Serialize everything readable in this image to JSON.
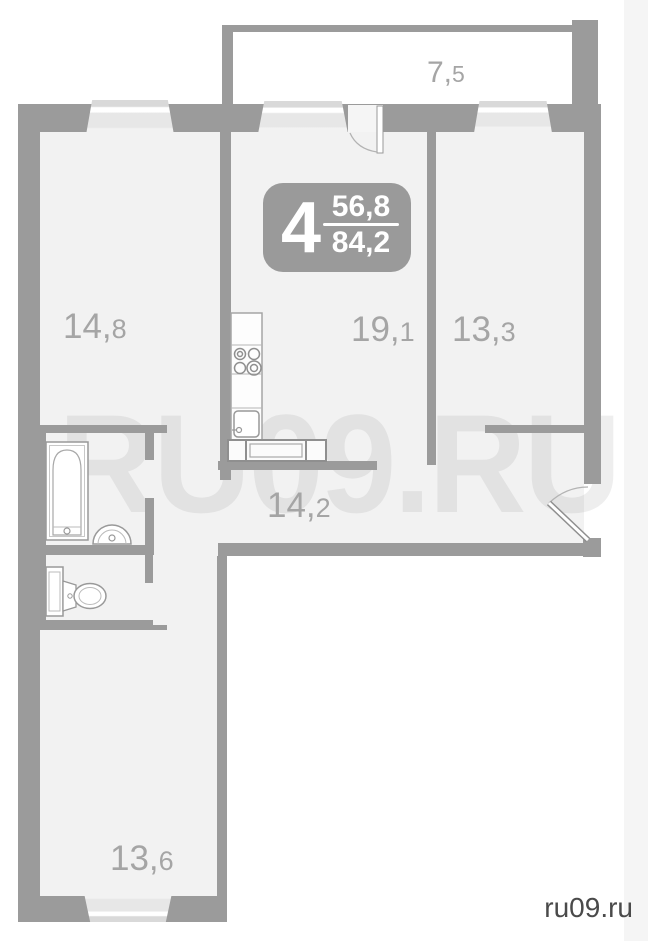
{
  "site_label": "ru09.ru",
  "watermark": "RU09.RU",
  "badge": {
    "rooms": "4",
    "area_top": "56,8",
    "area_bottom": "84,2"
  },
  "areas": {
    "balcony": {
      "main": "7,",
      "sub": "5"
    },
    "room_left": {
      "main": "14,",
      "sub": "8"
    },
    "living": {
      "main": "19,",
      "sub": "1"
    },
    "room_right": {
      "main": "13,",
      "sub": "3"
    },
    "hall": {
      "main": "14,",
      "sub": "2"
    },
    "room_bottom": {
      "main": "13,",
      "sub": "6"
    }
  },
  "colors": {
    "wall": "#9b9b9b",
    "room_fill": "#f2f2f2",
    "window_fill": "#e6e6e6",
    "label": "#a5a5a5",
    "badge_bg": "#9a9a9a",
    "badge_text": "#ffffff",
    "watermark": "#e6e6e6",
    "site_label": "#4a4a4a"
  }
}
